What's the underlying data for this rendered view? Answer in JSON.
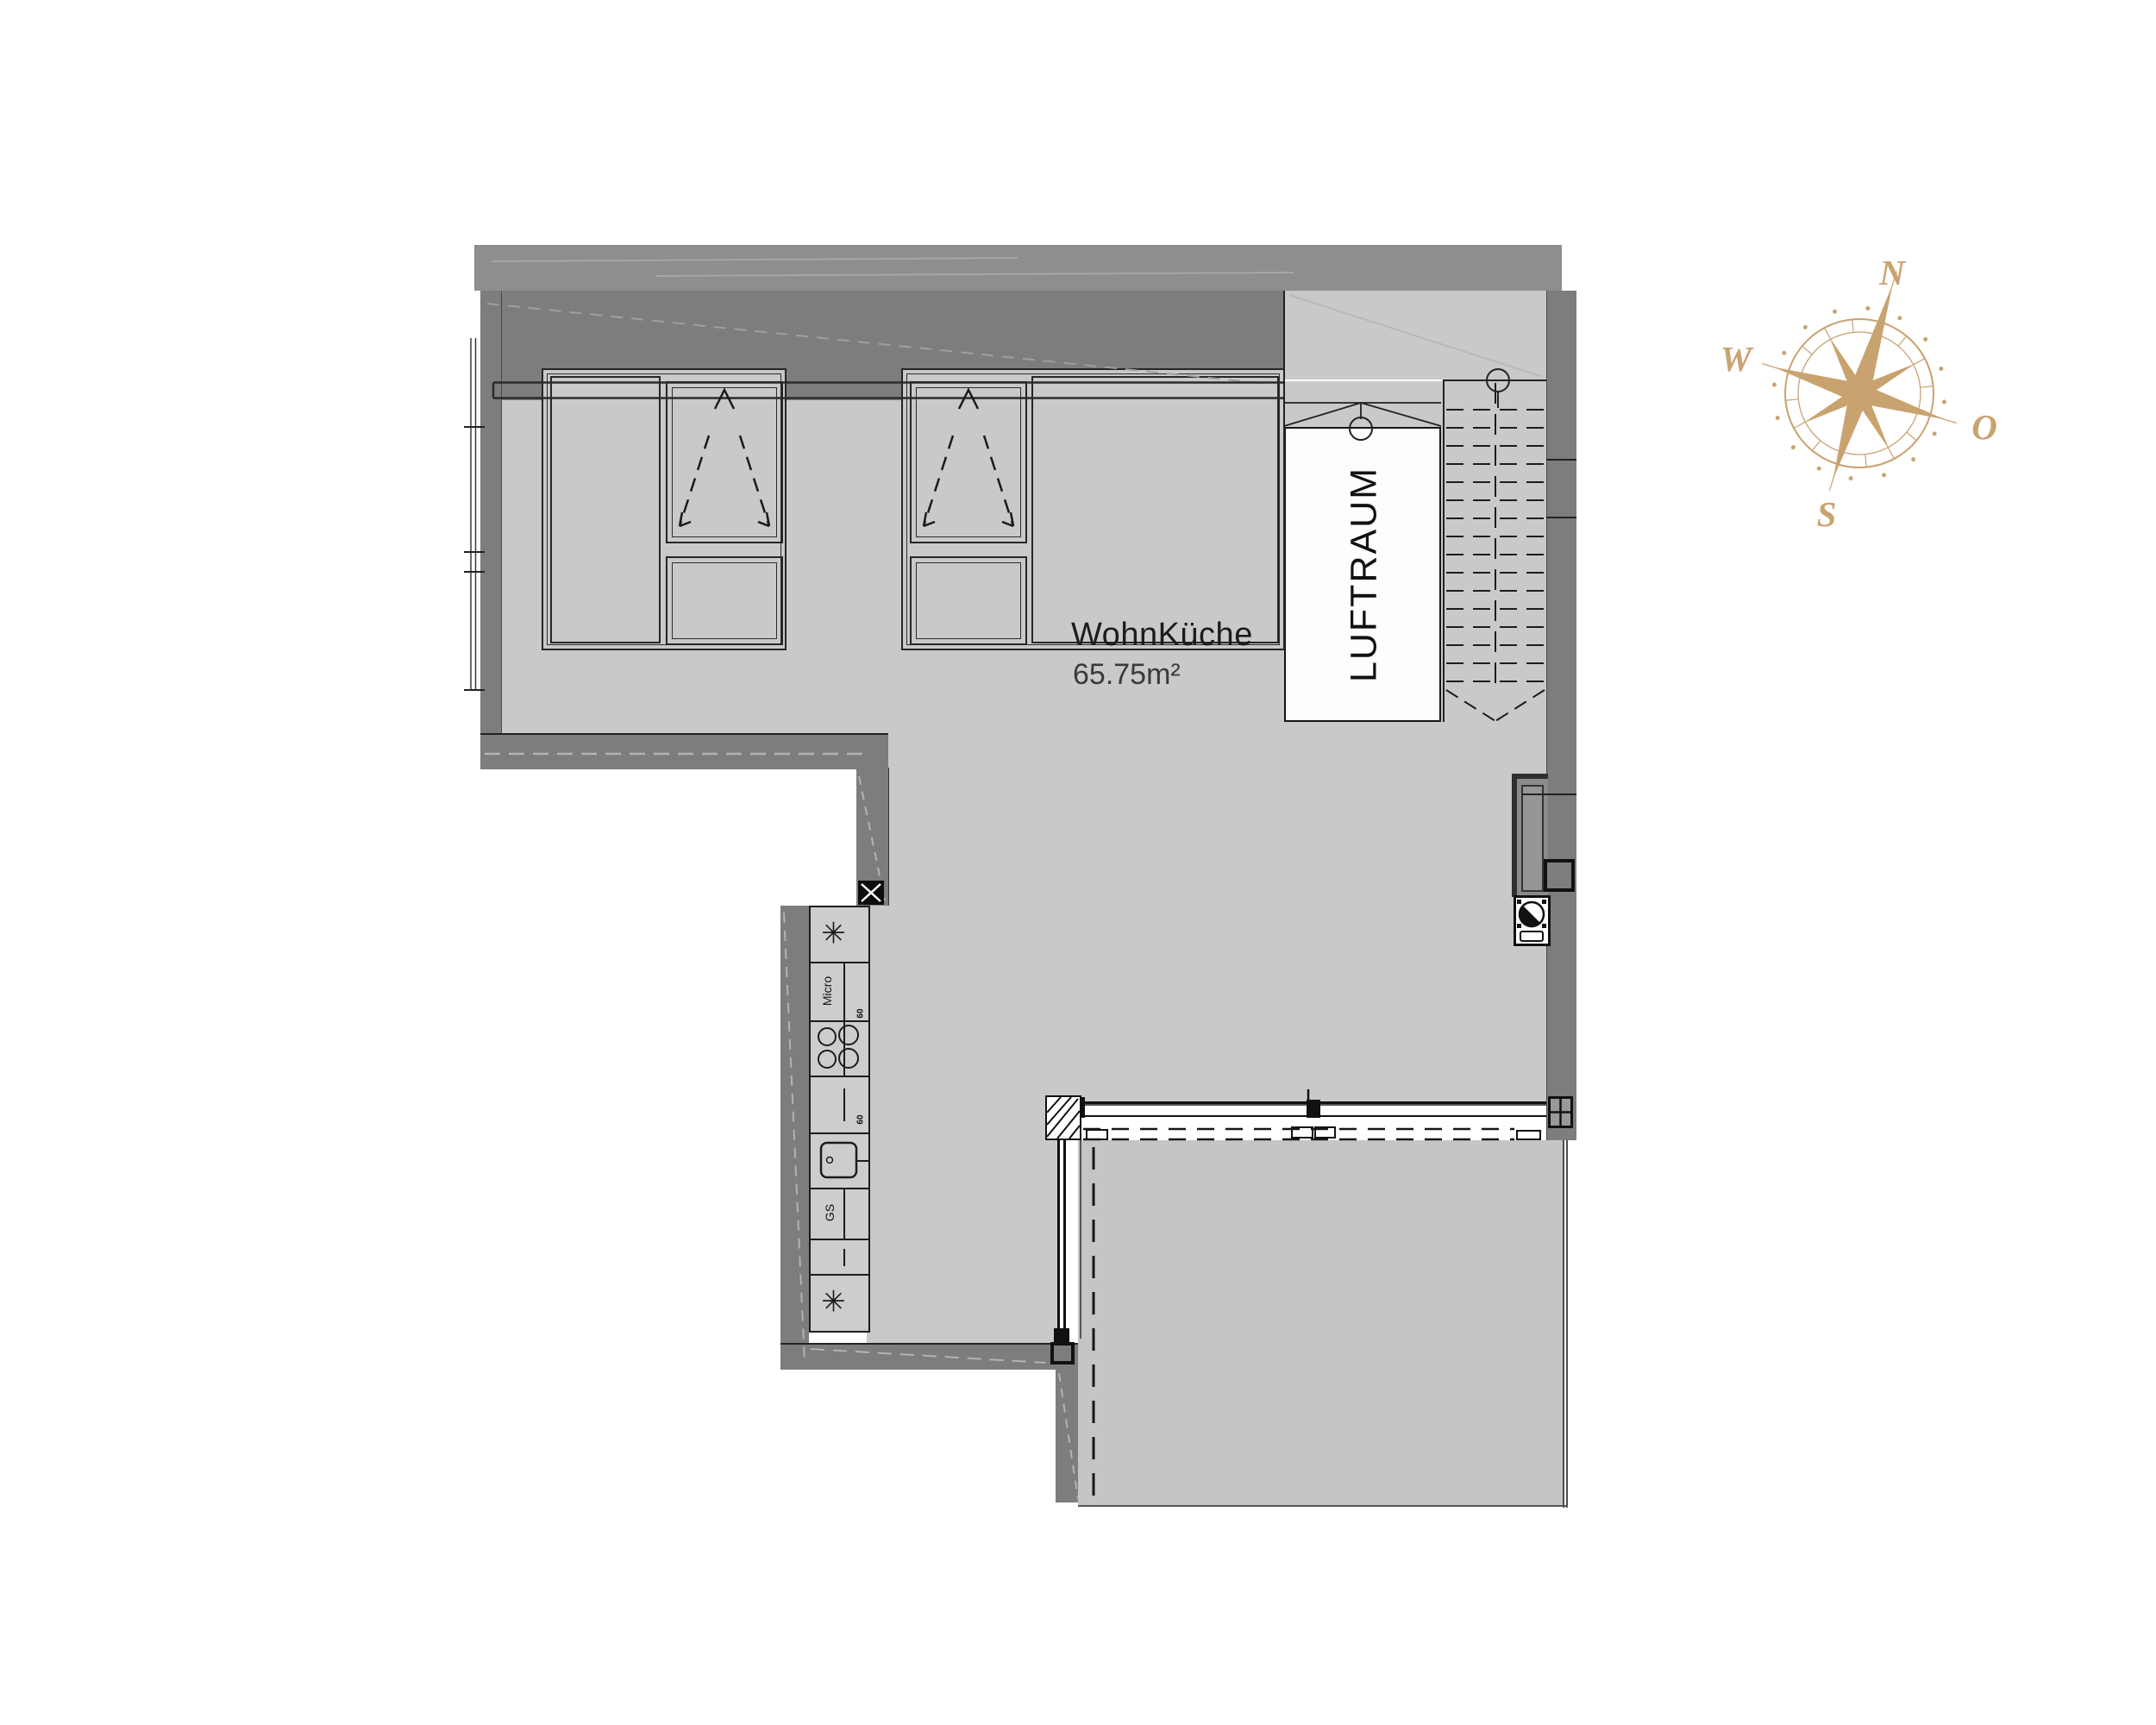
{
  "plan": {
    "rooms": {
      "living_kitchen": {
        "name": "WohnKüche",
        "area": "65.75m²"
      },
      "terrace": {
        "name": "Terrasse",
        "area": "20.01m²"
      },
      "air_space": {
        "name": "LUFTRAUM"
      }
    },
    "kitchen": {
      "microwave_label": "Micro",
      "dishwasher_label": "GS",
      "depth_label_upper": "60",
      "depth_label_lower": "60",
      "appliance_star": "✳"
    }
  },
  "compass": {
    "north": "N",
    "east": "O",
    "south": "S",
    "west": "W"
  },
  "colors": {
    "wall": "#7d7d7d",
    "roof_band": "#8e8e8e",
    "floor": "#c9c9c9",
    "terrace_floor": "#c5c5c5",
    "void_white": "#fdfdfd",
    "line": "#1c1c1c",
    "compass_gold": "#c9a36f"
  }
}
